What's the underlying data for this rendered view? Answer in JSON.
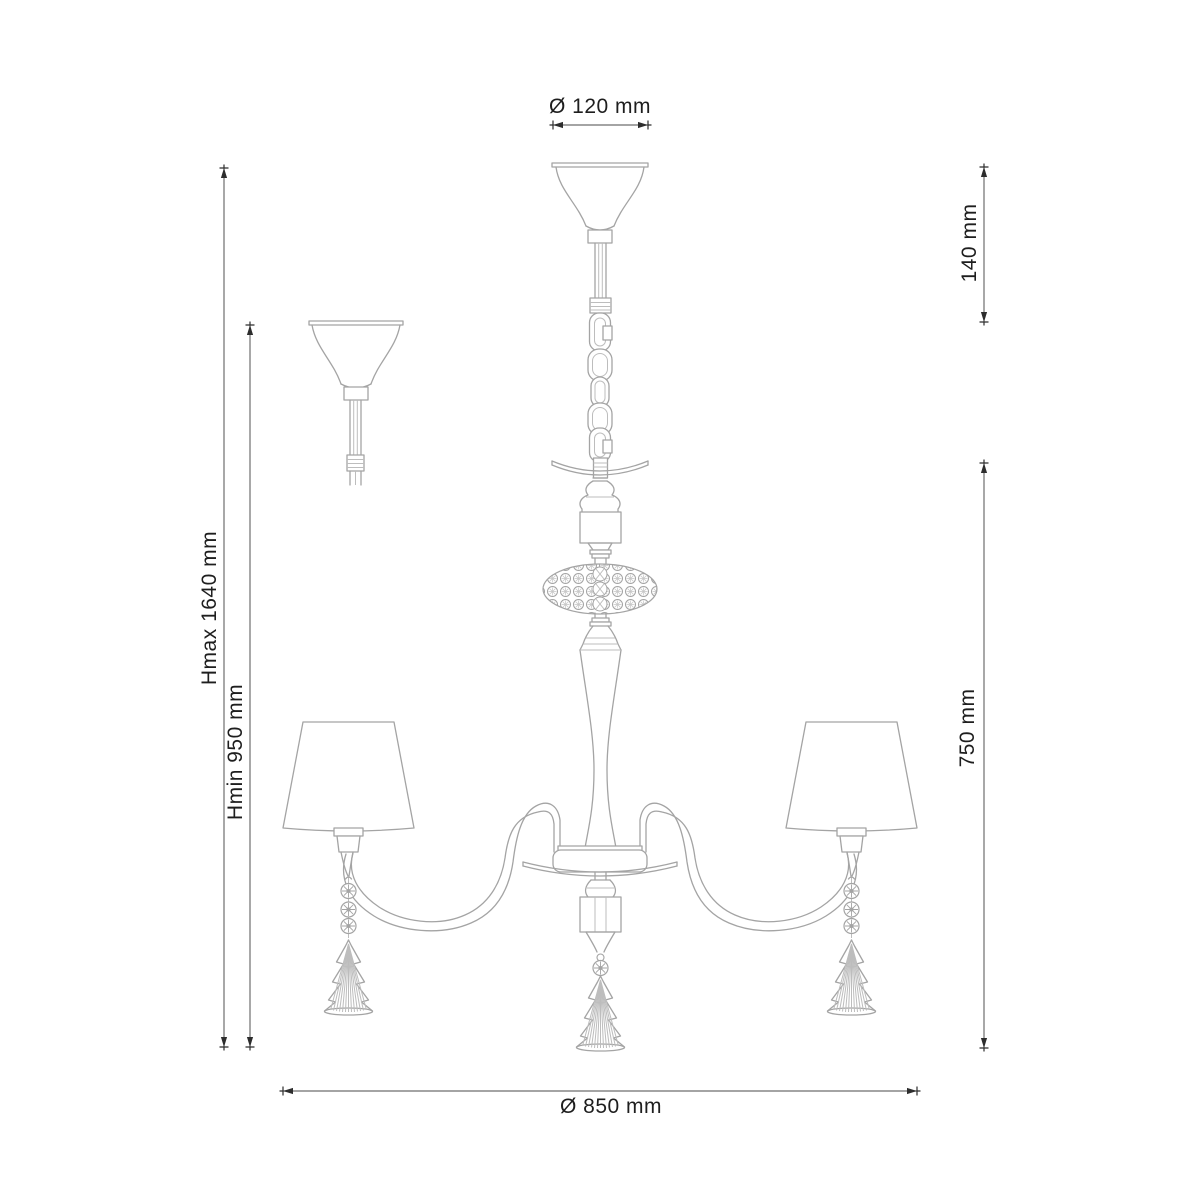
{
  "drawing": {
    "type": "technical-dimension-drawing",
    "subject": "chandelier with three lampshades, chain suspension, crystal ring and crystal fir-tree pendants",
    "background_color": "#ffffff",
    "line_color": "#a4a4a4",
    "dimension_line_color": "#6e6e6e",
    "text_color": "#1e1e1e",
    "dimensions": {
      "canopy_diameter": {
        "label": "Ø 120 mm",
        "orientation": "horizontal",
        "position": "top"
      },
      "suspension_height": {
        "label": "140 mm",
        "orientation": "vertical",
        "position": "upper-right"
      },
      "height_max": {
        "label": "Hmax 1640 mm",
        "orientation": "vertical",
        "position": "outer-left"
      },
      "height_min": {
        "label": "Hmin 950 mm",
        "orientation": "vertical",
        "position": "inner-left"
      },
      "body_height": {
        "label": "750 mm",
        "orientation": "vertical",
        "position": "lower-right"
      },
      "fixture_diameter": {
        "label": "Ø 850 mm",
        "orientation": "horizontal",
        "position": "bottom"
      }
    }
  }
}
